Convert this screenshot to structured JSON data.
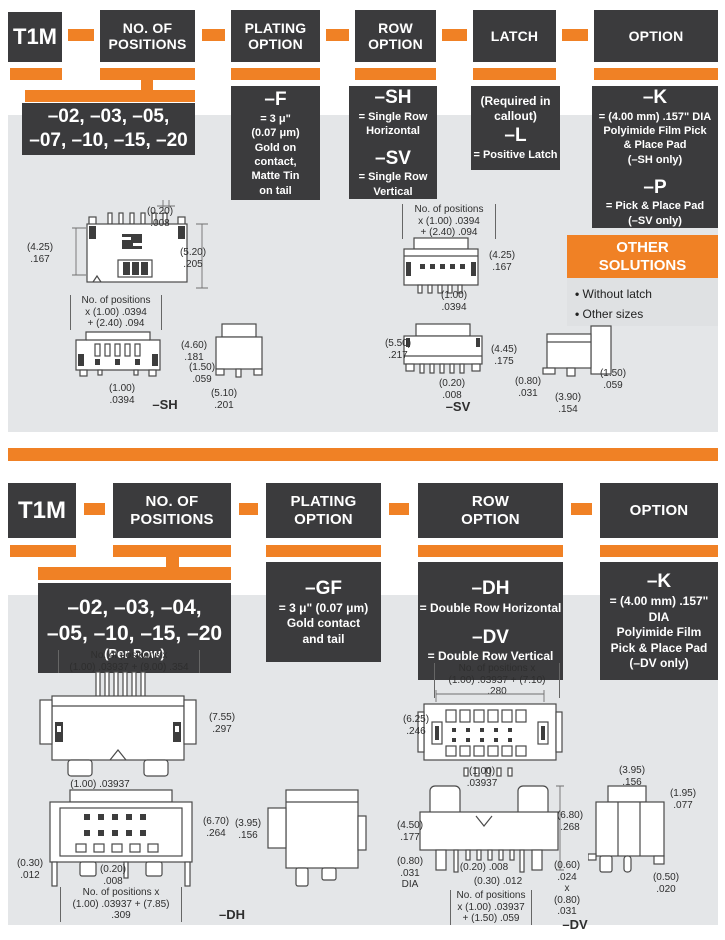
{
  "colors": {
    "accent_orange": "#F08125",
    "box_dark": "#3B3B3D",
    "panel_gray": "#E4E6E8"
  },
  "s1": {
    "part": "T1M",
    "boxes": {
      "positions": "NO. OF\nPOSITIONS",
      "plating": "PLATING\nOPTION",
      "row": "ROW\nOPTION",
      "latch": "LATCH",
      "option": "OPTION"
    },
    "positions_values": "–02, –03, –05,\n–07, –10, –15, –20",
    "plating_detail": {
      "code": "–F",
      "desc": "= 3 μ\"\n(0.07 μm)\nGold on\ncontact,\nMatte Tin\non tail"
    },
    "row_detail": {
      "code1": "–SH",
      "desc1": "= Single Row\nHorizontal",
      "code2": "–SV",
      "desc2": "= Single Row\nVertical"
    },
    "latch_detail": {
      "note": "(Required in\ncallout)",
      "code": "–L",
      "desc": "= Positive Latch"
    },
    "option_detail": {
      "code1": "–K",
      "desc1": "= (4.00 mm) .157\" DIA\nPolyimide Film Pick\n& Place Pad\n(–SH only)",
      "code2": "–P",
      "desc2": "= Pick & Place Pad\n(–SV only)"
    },
    "other": {
      "title": "OTHER\nSOLUTIONS",
      "items": [
        "Without latch",
        "Other sizes"
      ]
    },
    "dims": {
      "sh_top_020": "(0.20)\n.008",
      "sh_top_425": "(4.25)\n.167",
      "sh_top_520": "(5.20)\n.205",
      "sh_formula": "No. of positions\nx (1.00) .0394\n+ (2.40) .094",
      "sh_460": "(4.60)\n.181",
      "sh_100": "(1.00)\n.0394",
      "sh_150": "(1.50)\n.059",
      "sh_510": "(5.10)\n.201",
      "sh_label": "–SH",
      "sv_formula": "No. of positions\nx (1.00) .0394\n+ (2.40) .094",
      "sv_425": "(4.25)\n.167",
      "sv_100": "(1.00)\n.0394",
      "sv_550": "(5.50)\n.217",
      "sv_445": "(4.45)\n.175",
      "sv_020": "(0.20)\n.008",
      "sv_label": "–SV",
      "sv_080": "(0.80)\n.031",
      "sv_390": "(3.90)\n.154",
      "sv_150": "(1.50)\n.059"
    }
  },
  "s2": {
    "part": "T1M",
    "boxes": {
      "positions": "NO. OF\nPOSITIONS",
      "plating": "PLATING\nOPTION",
      "row": "ROW\nOPTION",
      "option": "OPTION"
    },
    "positions_values": "–02, –03, –04,\n–05, –10, –15, –20",
    "positions_note": "(Per Row)",
    "plating_detail": {
      "code": "–GF",
      "desc": "= 3 μ\" (0.07 μm)\nGold contact\nand tail"
    },
    "row_detail": {
      "code1": "–DH",
      "desc1": "= Double Row Horizontal",
      "code2": "–DV",
      "desc2": "= Double Row Vertical"
    },
    "option_detail": {
      "code": "–K",
      "desc": "= (4.00 mm) .157\" DIA\nPolyimide Film\nPick & Place Pad\n(–DV only)"
    },
    "dims": {
      "dh_formula_top": "No. of positions x\n(1.00) .03937 + (9.00) .354",
      "dh_755": "(7.55)\n.297",
      "dh_100": "(1.00) .03937",
      "dh_670": "(6.70)\n.264",
      "dh_395": "(3.95)\n.156",
      "dh_030": "(0.30)\n.012",
      "dh_020": "(0.20)\n.008",
      "dh_formula_bottom": "No. of positions x\n(1.00) .03937 + (7.85) .309",
      "dh_label": "–DH",
      "dv_formula_top": "No. of positions x\n(1.00) .03937 + (7.10) .280",
      "dv_625": "(6.25)\n.246",
      "dv_100": "(1.00)\n.03937",
      "dv_450": "(4.50)\n.177",
      "dv_680": "(6.80)\n.268",
      "dv_080dia": "(0.80)\n.031\nDIA",
      "dv_020": "(0.20) .008",
      "dv_030": "(0.30) .012",
      "dv_formula_bottom": "No. of positions\nx (1.00) .03937\n+ (1.50) .059",
      "dv_060": "(0.60)\n.024\nx\n(0.80)\n.031",
      "dv_label": "–DV",
      "dv_395": "(3.95)\n.156",
      "dv_195": "(1.95)\n.077",
      "dv_050": "(0.50)\n.020"
    }
  }
}
